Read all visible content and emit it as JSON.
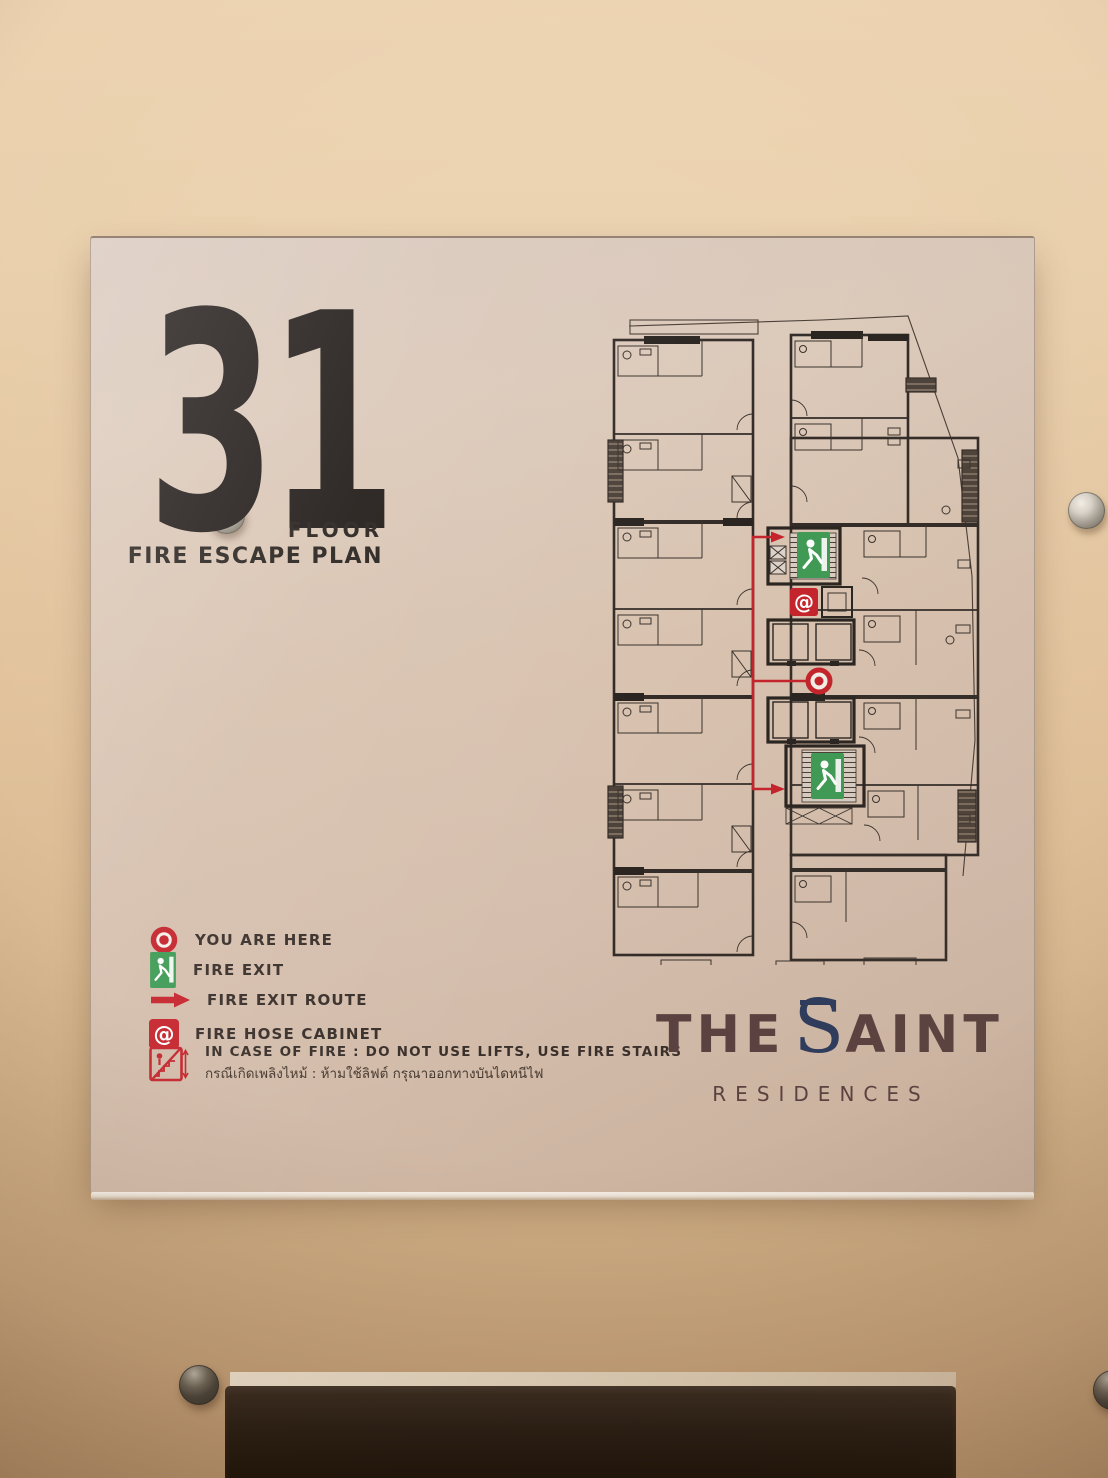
{
  "floor_header": {
    "number": "31",
    "floor_label": "FLOOR",
    "plan_title": "FIRE ESCAPE PLAN"
  },
  "legend": {
    "items": [
      {
        "icon": "you-are-here-bullseye-icon",
        "label": "YOU ARE HERE"
      },
      {
        "icon": "fire-exit-icon",
        "label": "FIRE EXIT"
      },
      {
        "icon": "fire-exit-route-arrow-icon",
        "label": "FIRE EXIT ROUTE"
      },
      {
        "icon": "fire-hose-cabinet-icon",
        "label": "FIRE HOSE CABINET"
      },
      {
        "icon": "no-lifts-use-stairs-icon",
        "label": "IN CASE OF FIRE : DO NOT USE LIFTS, USE FIRE STAIRS",
        "label_thai": "กรณีเกิดเพลิงไหม้ : ห้ามใช้ลิฟต์ กรุณาออกทางบันไดหนีไฟ"
      }
    ],
    "hose_glyph": "@"
  },
  "brand": {
    "word_the": "THE",
    "letter_s": "S",
    "word_aint": "AINT",
    "subtitle": "RESIDENCES"
  },
  "colors": {
    "route_red": "#c5242c",
    "exit_green": "#3f9b55",
    "brand_navy": "#2d3b5d",
    "brand_brown": "#5a4240",
    "plan_ink": "#332c28",
    "wall_paint": "#e0c2a0",
    "panel_tint": "#d6c2b2"
  }
}
